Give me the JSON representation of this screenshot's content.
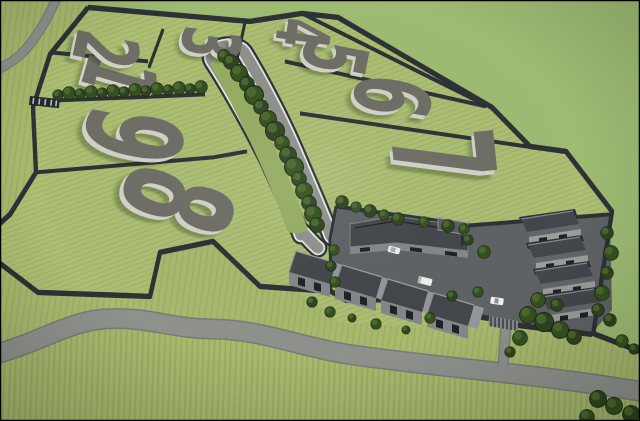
{
  "scene": {
    "type": "aerial-3d-site-plan-render",
    "description": "Aerial 3D rendering of a walled land development: nine numbered grass plots, a tree-lined central boulevard, a building compound with row houses, access roads and surrounding crop fields"
  },
  "plots": [
    {
      "label": "1"
    },
    {
      "label": "2"
    },
    {
      "label": "3"
    },
    {
      "label": "4"
    },
    {
      "label": "5"
    },
    {
      "label": "6"
    },
    {
      "label": "7"
    },
    {
      "label": "8"
    },
    {
      "label": "9"
    }
  ],
  "counts": {
    "plots": 9,
    "row_buildings": 4,
    "east_buildings": 4,
    "vehicles": 3
  },
  "colors": {
    "grass": "#a8ba6e",
    "grass-row": "#7f9350",
    "grass-plots": "#adbf73",
    "grass-far": "#9fbd74",
    "grass-median": "#96ad62",
    "road": "#8e918c",
    "road-edge": "#787c76",
    "curb": "#e8e8e2",
    "wall": "#2d3237",
    "wall-cap": "#575d63",
    "num-top": "#6e6e67",
    "num-side": "#d2d2ca",
    "num-shadow": "#233018",
    "paving": "#5e6265",
    "roof-dark": "#43474b",
    "roof-mid": "#62666a",
    "roof-light": "#94979a",
    "bld-wall": "#84878a",
    "bld-wall-light": "#9a9d9a",
    "slot": "#1f2225",
    "tree-dark": "#1c2a14",
    "tree-mid": "#2e4420",
    "tree-light": "#4e6c31",
    "car": "#eef0ea",
    "frame": "#000000"
  }
}
